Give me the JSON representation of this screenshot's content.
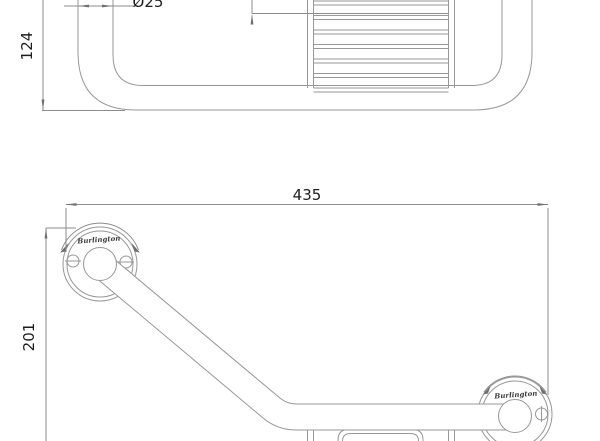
{
  "colors": {
    "background": "#ffffff",
    "line": "#979797",
    "dimension_line": "#8d8d8d",
    "text": "#1c1c1c",
    "brand_text": "#3a3a3a"
  },
  "top_view": {
    "dim_depth": "124",
    "dim_tube_diameter": "Ø25"
  },
  "front_view": {
    "dim_width": "435",
    "dim_height": "201",
    "brand_left": "Burlington",
    "brand_right": "Burlington"
  }
}
